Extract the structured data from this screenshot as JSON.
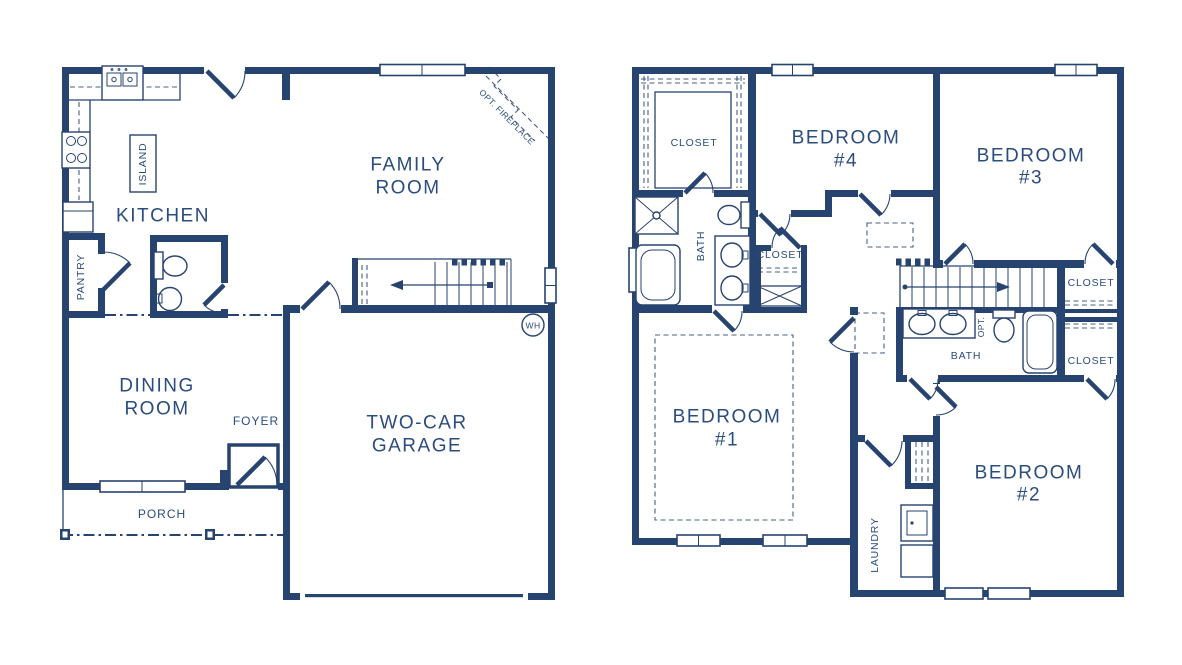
{
  "colors": {
    "ink": "#27436F",
    "label": "#2B4C7E",
    "background": "#ffffff"
  },
  "first_floor": {
    "family_room_line1": "FAMILY",
    "family_room_line2": "ROOM",
    "kitchen": "KITCHEN",
    "island": "ISLAND",
    "pantry": "PANTRY",
    "dining_line1": "DINING",
    "dining_line2": "ROOM",
    "foyer": "FOYER",
    "porch": "PORCH",
    "garage_line1": "TWO-CAR",
    "garage_line2": "GARAGE",
    "opt_fireplace": "OPT. FIREPLACE",
    "water_heater": "WH"
  },
  "second_floor": {
    "owner_closet": "CLOSET",
    "owner_bath": "BATH",
    "hall_closet": "CLOSET",
    "bedroom1_line1": "BEDROOM",
    "bedroom1_line2": "#1",
    "bedroom2_line1": "BEDROOM",
    "bedroom2_line2": "#2",
    "bedroom3_line1": "BEDROOM",
    "bedroom3_line2": "#3",
    "bedroom4_line1": "BEDROOM",
    "bedroom4_line2": "#4",
    "bath2": "BATH",
    "bath2_opt": "OPT.",
    "closet_bedroom3": "CLOSET",
    "closet_bedroom2": "CLOSET",
    "laundry": "LAUNDRY"
  }
}
